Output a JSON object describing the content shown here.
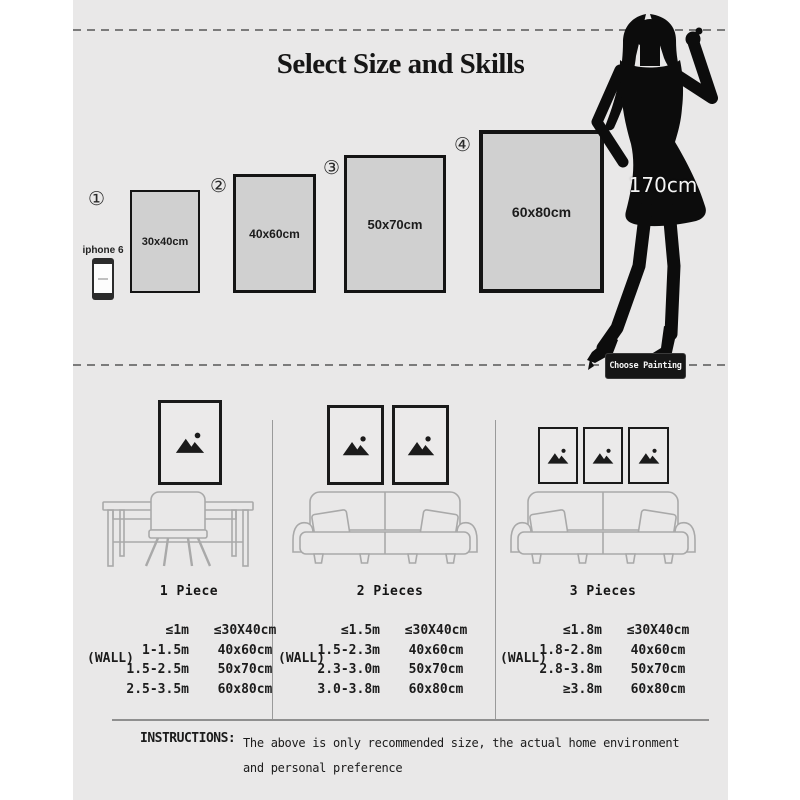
{
  "header": {
    "title": "Select Size and Skills"
  },
  "sizes": [
    {
      "number": "①",
      "size": "30x40cm"
    },
    {
      "number": "②",
      "size": "40x60cm"
    },
    {
      "number": "③",
      "size": "50x70cm"
    },
    {
      "number": "④",
      "size": "60x80cm"
    }
  ],
  "reference": {
    "phone_label": "iphone 6",
    "person_height": "170cm",
    "choose_button": "Choose Painting"
  },
  "scenes": [
    {
      "label": "1 Piece",
      "frames": 1
    },
    {
      "label": "2 Pieces",
      "frames": 2
    },
    {
      "label": "3 Pieces",
      "frames": 3
    }
  ],
  "tables": [
    {
      "wall_label": "(WALL)",
      "rows": [
        [
          "≤1m",
          "≤30X40cm"
        ],
        [
          "1-1.5m",
          "40x60cm"
        ],
        [
          "1.5-2.5m",
          "50x70cm"
        ],
        [
          "2.5-3.5m",
          "60x80cm"
        ]
      ]
    },
    {
      "wall_label": "(WALL)",
      "rows": [
        [
          "≤1.5m",
          "≤30X40cm"
        ],
        [
          "1.5-2.3m",
          "40x60cm"
        ],
        [
          "2.3-3.0m",
          "50x70cm"
        ],
        [
          "3.0-3.8m",
          "60x80cm"
        ]
      ]
    },
    {
      "wall_label": "(WALL)",
      "rows": [
        [
          "≤1.8m",
          "≤30X40cm"
        ],
        [
          "1.8-2.8m",
          "40x60cm"
        ],
        [
          "2.8-3.8m",
          "50x70cm"
        ],
        [
          "≥3.8m",
          "60x80cm"
        ]
      ]
    }
  ],
  "instructions": {
    "label": "INSTRUCTIONS:",
    "line1": "The above is only recommended size, the actual home environment",
    "line2": "and personal preference"
  },
  "colors": {
    "canvas_bg": "#e9e8e8",
    "panel_fill": "#d0d0d0",
    "ink": "#1b1b1b",
    "line_gray": "#a9a9a9",
    "button_bg": "#161616"
  }
}
